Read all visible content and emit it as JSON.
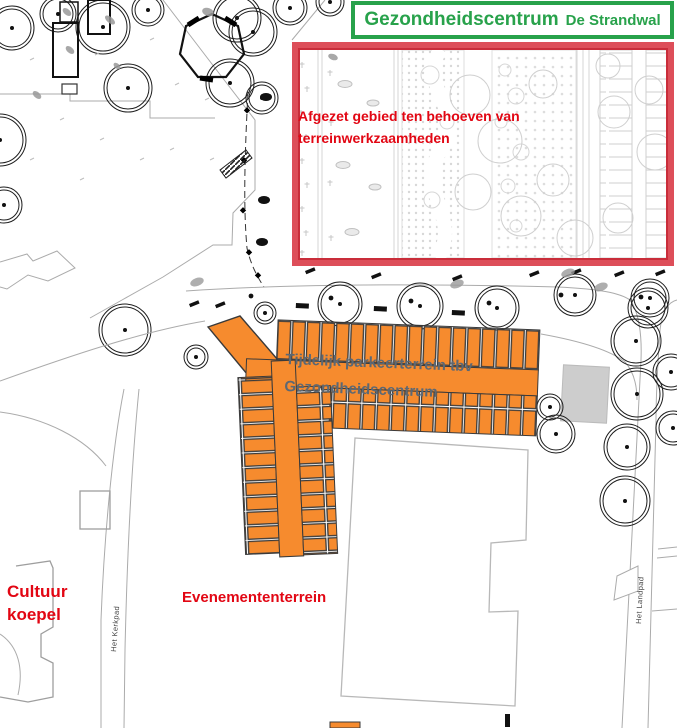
{
  "header": {
    "title": "Gezondheidscentrum",
    "subtitle": "De Strandwal"
  },
  "restricted_area": {
    "label_line1": "Afgezet gebied ten behoeven van",
    "label_line2": "terreinwerkzaamheden"
  },
  "parking": {
    "label_line1": "Tijdelijk parkeerterrein tbv",
    "label_line2": "Gezondheidscentrum"
  },
  "zones": {
    "cultuur_line1": "Cultuur",
    "cultuur_line2": "koepel",
    "event": "Evenemententerrein"
  },
  "roads": {
    "west": "Het Kerkpad",
    "east": "Het Landpad"
  },
  "colors": {
    "title_green": "#28a24b",
    "restricted_border_red": "#dd4e59",
    "annotation_red": "#e20613",
    "parking_orange": "#f68b2e",
    "parking_text_gray": "#5d6873"
  }
}
